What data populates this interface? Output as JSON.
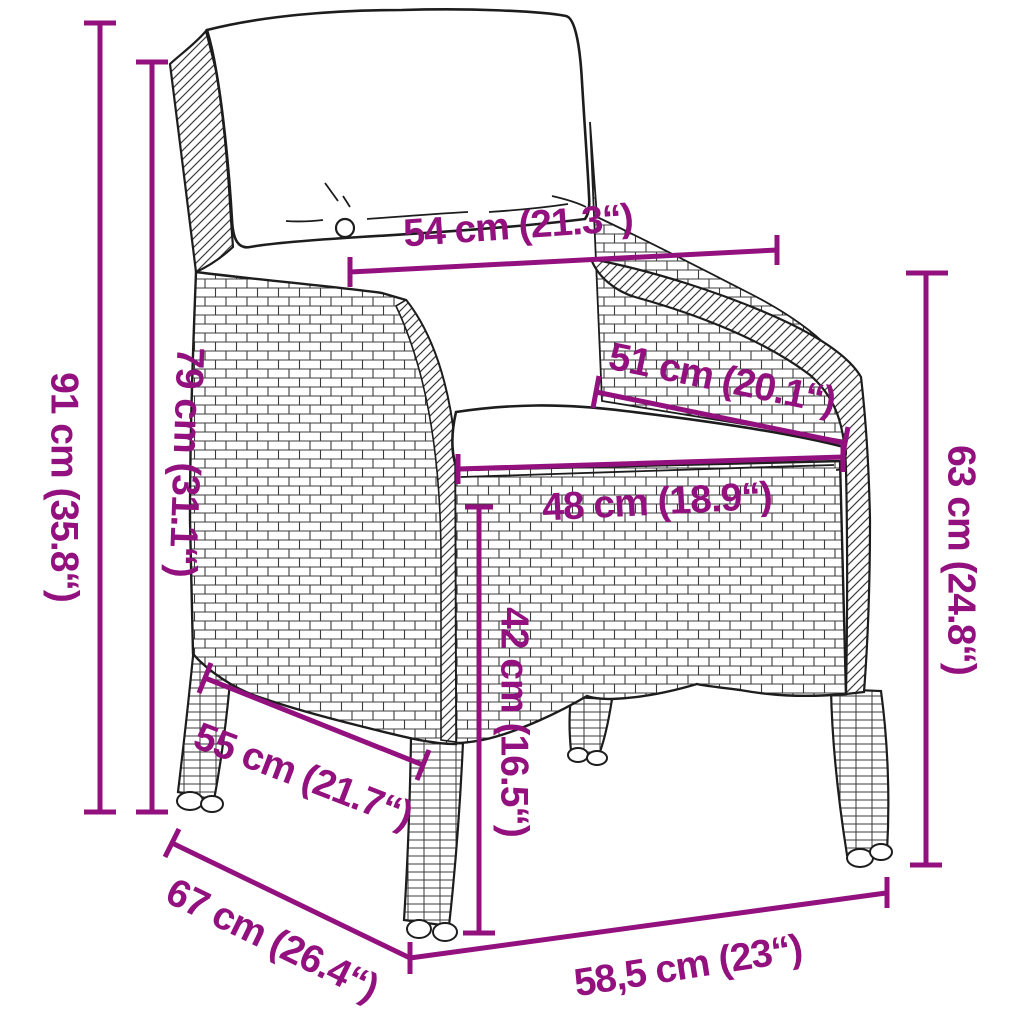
{
  "diagram": {
    "type": "product-dimension-diagram",
    "subject": "Poly rattan garden chair with back and seat cushions, line-art drawing annotated with measurements",
    "background_color": "#ffffff",
    "accent_color": "#93117e",
    "outline_color": "#1d1d1d"
  },
  "measurements": {
    "total_height": "91 cm (35.8“)",
    "armrest_height": "79 cm (31.1“)",
    "backrest_width": "54 cm (21.3“)",
    "seat_depth": "51 cm (20.1“)",
    "seat_width": "48 cm (18.9“)",
    "seat_height": "42 cm (16.5“)",
    "backrest_height": "63 cm (24.8“)",
    "side_depth": "55 cm (21.7“)",
    "total_depth": "67 cm (26.4“)",
    "total_width": "58,5 cm (23“)"
  }
}
